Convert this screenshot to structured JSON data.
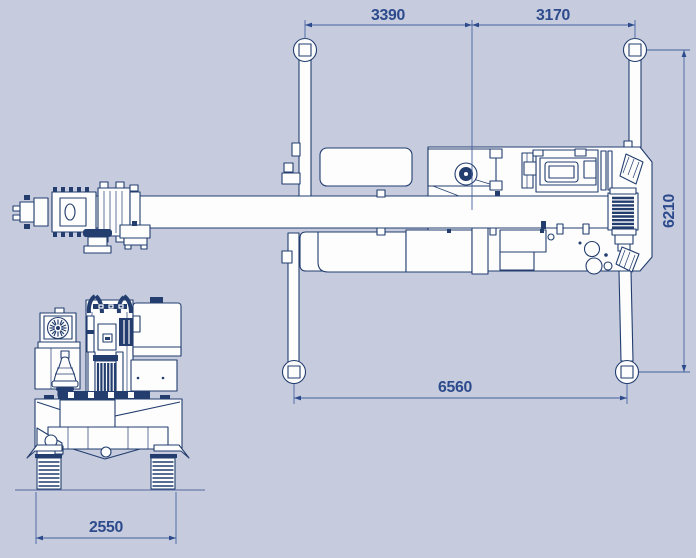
{
  "document": {
    "type": "technical-drawing",
    "subject": "Mobile crane outrigger footprint, top view and front view",
    "views": [
      {
        "id": "top-view",
        "label": "plan view with outriggers extended"
      },
      {
        "id": "front-view",
        "label": "front elevation view"
      }
    ],
    "colors": {
      "background": "#c6ccde",
      "ink": "#223d6e",
      "dimension_lines": "#44619f",
      "dimension_text": "#2c4a8c",
      "fill_white": "#fdfdfe"
    },
    "dimensions": {
      "top_left_span": "3390",
      "top_right_span": "3170",
      "right_side_height": "6210",
      "bottom_span": "6560",
      "front_view_width": "2550"
    }
  }
}
